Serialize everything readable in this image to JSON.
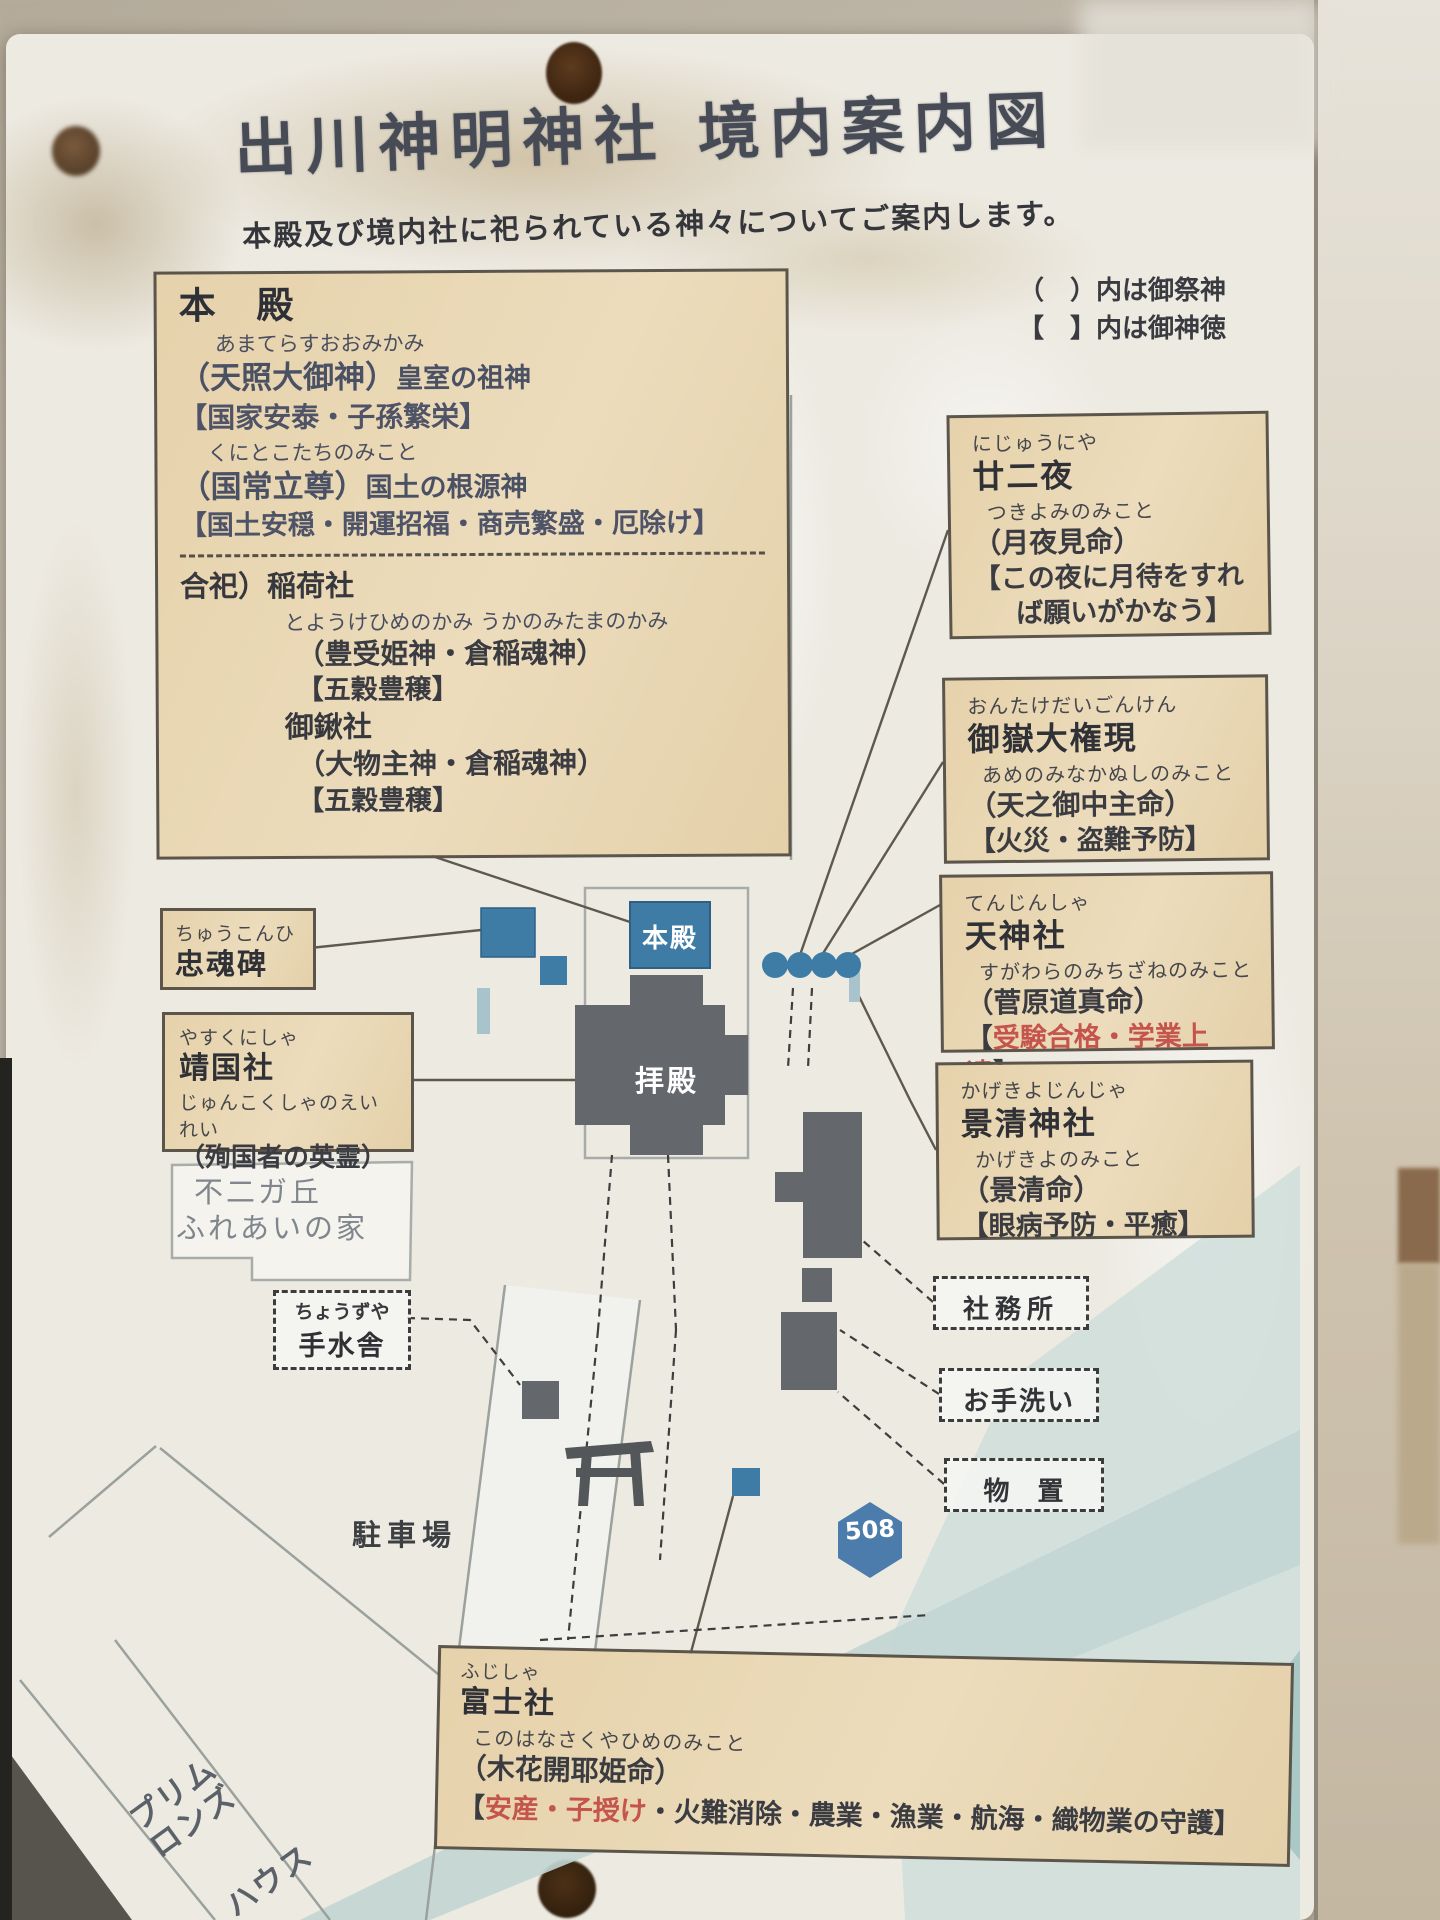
{
  "title": "出川神明神社 境内案内図",
  "subtitle": "本殿及び境内社に祀られている神々についてご案内します。",
  "legend": {
    "saijin": "（　）内は御祭神",
    "shintoku": "【　】内は御神徳"
  },
  "honden": {
    "heading": "本 殿",
    "f1": "あまてらすおおみかみ",
    "d1": "（天照大御神）",
    "d1_note": "皇室の祖神",
    "v1": "【国家安泰・子孫繁栄】",
    "f2": "くにとこたちのみこと",
    "d2": "（国常立尊）",
    "d2_note": "国土の根源神",
    "v2": "【国土安穏・開運招福・商売繁盛・厄除け】",
    "goshi": "合祀）稲荷社",
    "inari_furigana": "とようけひめのかみ うかのみたまのかみ",
    "inari_kami": "（豊受姫神・倉稲魂神）",
    "inari_virtue": "【五穀豊穣】",
    "okuwa": "御鍬社",
    "okuwa_kami": "（大物主神・倉稲魂神）",
    "okuwa_virtue": "【五穀豊穣】"
  },
  "nijuuniya": {
    "furigana": "にじゅうにや",
    "name": "廿二夜",
    "kami_furigana": "つきよみのみこと",
    "kami": "（月夜見命）",
    "virtue_l1": "【この夜に月待をすれ",
    "virtue_l2": "ば願いがかなう】"
  },
  "ontake": {
    "furigana": "おんたけだいごんけん",
    "name": "御嶽大権現",
    "kami_furigana": "あめのみなかぬしのみこと",
    "kami": "（天之御中主命）",
    "virtue": "【火災・盗難予防】"
  },
  "tenjin": {
    "furigana": "てんじんしゃ",
    "name": "天神社",
    "kami_furigana": "すがわらのみちざねのみこと",
    "kami": "（菅原道真命）",
    "virtue_open": "【",
    "virtue_red": "受験合格・学業上達",
    "virtue_close": "】"
  },
  "kagekiyo": {
    "furigana": "かげきよじんじゃ",
    "name": "景清神社",
    "kami_furigana": "かげきよのみこと",
    "kami": "（景清命）",
    "virtue": "【眼病予防・平癒】"
  },
  "chukonhi": {
    "furigana": "ちゅうこんひ",
    "name": "忠魂碑"
  },
  "yasukuni": {
    "furigana": "やすくにしゃ",
    "name": "靖国社",
    "kami_furigana": "じゅんこくしゃのえいれい",
    "kami": "（殉国者の英霊）"
  },
  "fujisha": {
    "furigana": "ふじしゃ",
    "name": "富士社",
    "kami_furigana": "このはなさくやひめのみこと",
    "kami": "（木花開耶姫命）",
    "virtue_open": "【",
    "virtue_red": "安産・子授け",
    "virtue_rest": "・火難消除・農業・漁業・航海・織物業の守護】"
  },
  "map": {
    "honden_label": "本殿",
    "haiden_label": "拝殿",
    "fujigaoka_l1": "不二ガ丘",
    "fujigaoka_l2": "ふれあいの家",
    "chozuya_furigana": "ちょうずや",
    "chozuya": "手水舎",
    "shamusho": "社務所",
    "otearai": "お手洗い",
    "monooki": "物　置",
    "parking": "駐車場",
    "route_number": "508",
    "handwriting_l1": "プリム",
    "handwriting_l2": "ロンズ",
    "handwriting_l3": "ハウス"
  },
  "colors": {
    "box_background": "#e8d6b4",
    "box_border": "#5c554a",
    "red_text": "#c4544c",
    "blue_building": "#3e7ca6",
    "gray_building": "#64676c",
    "route_shield": "#4c7cab"
  }
}
